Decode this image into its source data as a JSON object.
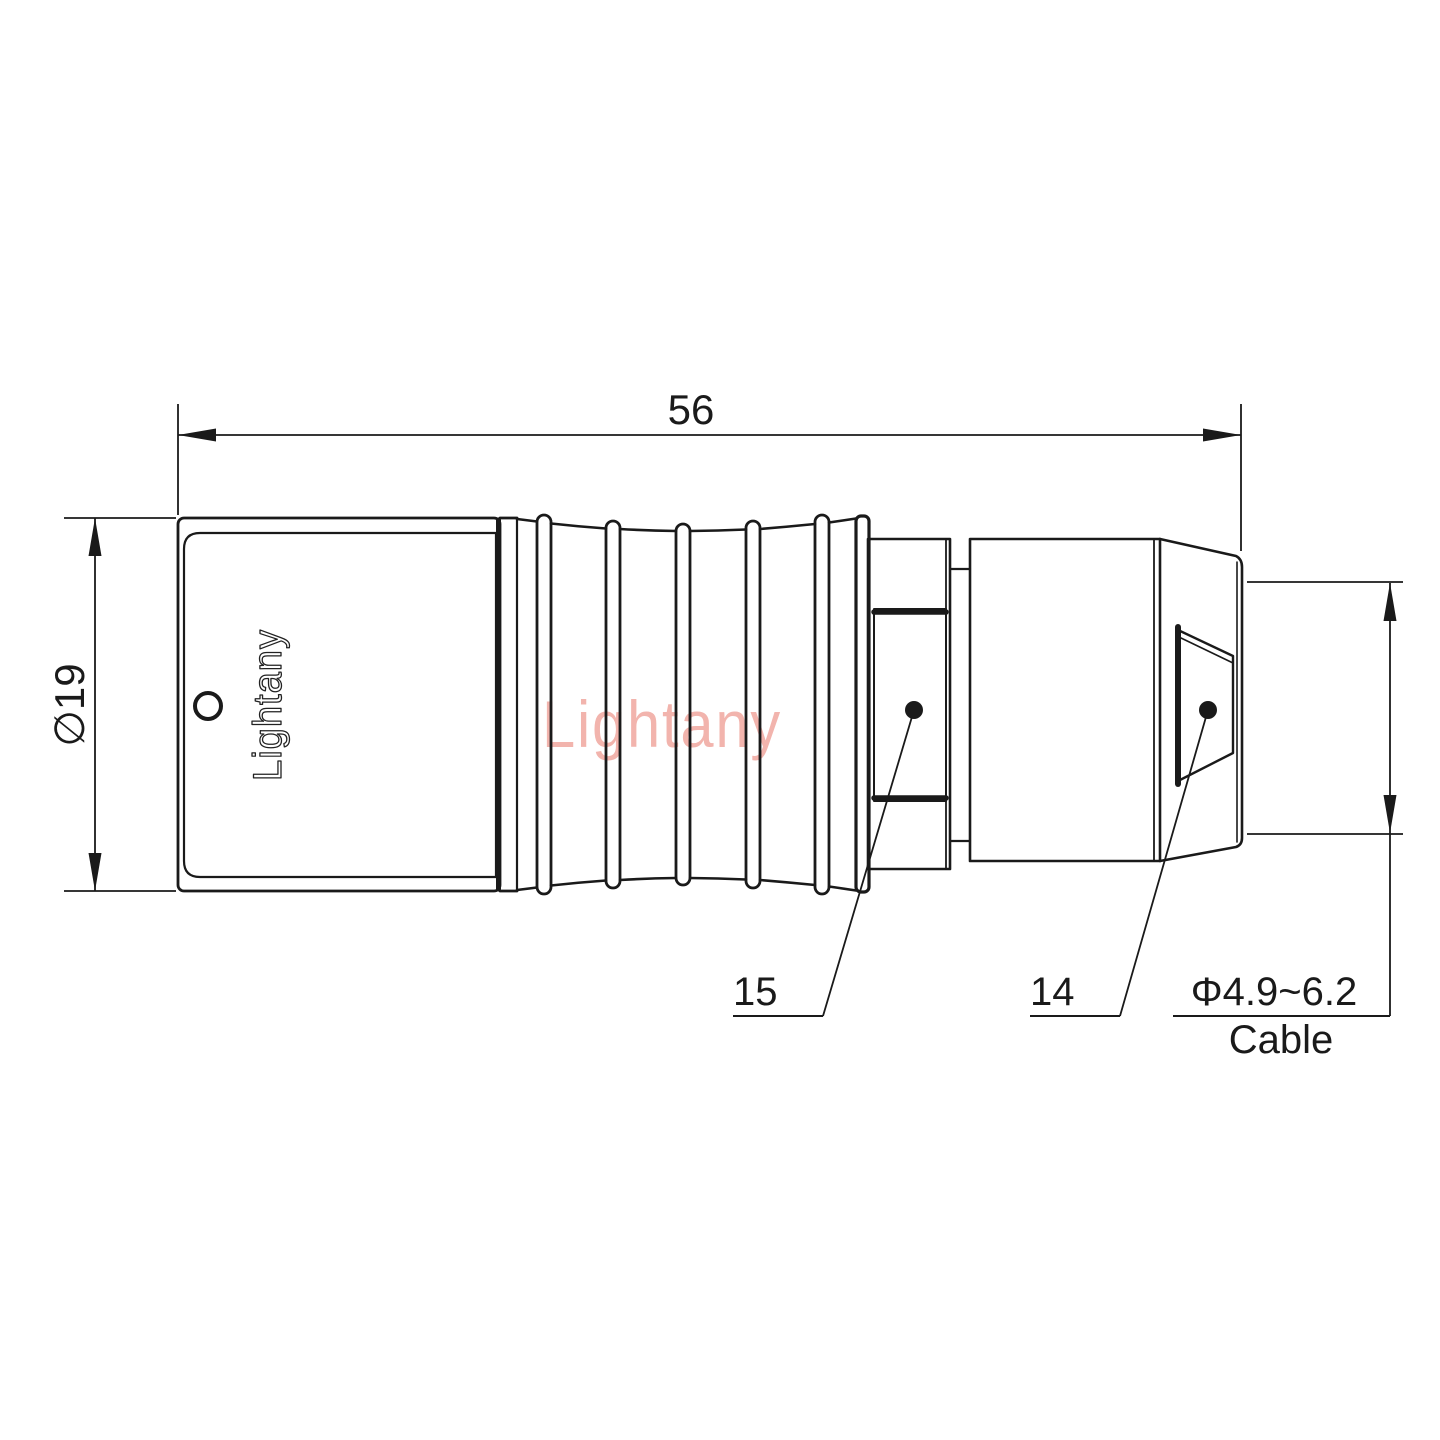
{
  "labels": {
    "overall_length": "56",
    "diameter": "∅19",
    "part_left": "15",
    "part_right": "14",
    "cable_range": "Φ4.9~6.2",
    "cable": "Cable"
  },
  "branding": {
    "engraving": "Lightany",
    "watermark": "Lightany"
  },
  "colors": {
    "line": "#1a1a1a",
    "watermark": "#f2b4ad",
    "background": "#ffffff"
  }
}
